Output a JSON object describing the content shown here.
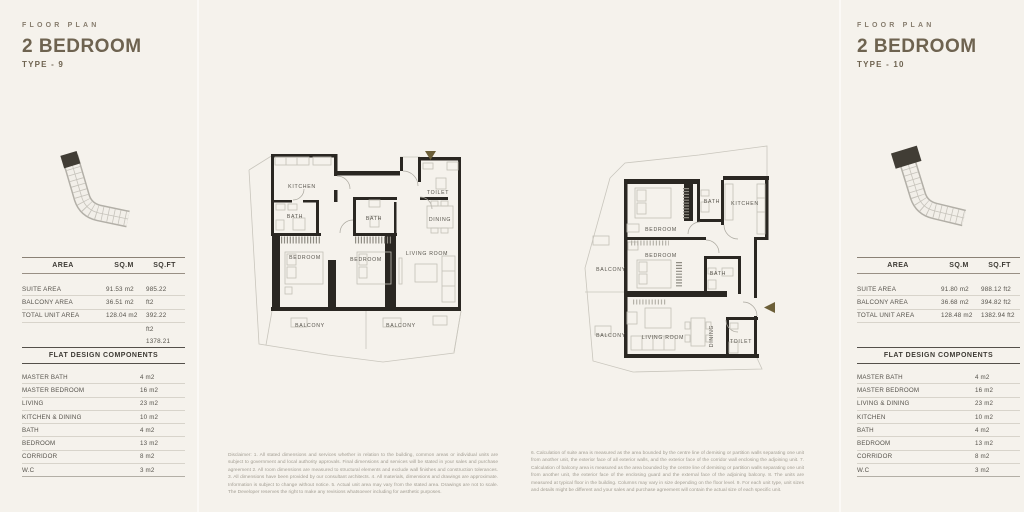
{
  "left": {
    "eyebrow": "FLOOR PLAN",
    "title": "2 BEDROOM",
    "type_label": "TYPE - 9",
    "area": {
      "headers": [
        "AREA",
        "SQ.M",
        "SQ.FT"
      ],
      "rows": [
        {
          "label": "SUITE AREA",
          "sqm": "91.53 m2",
          "sqft": "985.22"
        },
        {
          "label": "BALCONY AREA",
          "sqm": "36.51 m2",
          "sqft": "ft2"
        },
        {
          "label": "TOTAL UNIT AREA",
          "sqm": "128.04 m2",
          "sqft": "392.22"
        },
        {
          "label": "",
          "sqm": "",
          "sqft": "ft2"
        },
        {
          "label": "",
          "sqm": "",
          "sqft": "1378.21"
        }
      ]
    },
    "components_title": "FLAT DESIGN COMPONENTS",
    "components": [
      {
        "label": "MASTER BATH",
        "value": "4 m2"
      },
      {
        "label": "MASTER BEDROOM",
        "value": "16 m2"
      },
      {
        "label": "LIVING",
        "value": "23 m2"
      },
      {
        "label": "KITCHEN & DINING",
        "value": "10 m2"
      },
      {
        "label": "BATH",
        "value": "4 m2"
      },
      {
        "label": "BEDROOM",
        "value": "13 m2"
      },
      {
        "label": "CORRIDOR",
        "value": "8 m2"
      },
      {
        "label": "W.C",
        "value": "3 m2"
      }
    ]
  },
  "right": {
    "eyebrow": "FLOOR PLAN",
    "title": "2 BEDROOM",
    "type_label": "TYPE - 10",
    "area": {
      "headers": [
        "AREA",
        "SQ.M",
        "SQ.FT"
      ],
      "rows": [
        {
          "label": "SUITE AREA",
          "sqm": "91.80 m2",
          "sqft": "988.12 ft2"
        },
        {
          "label": "BALCONY AREA",
          "sqm": "36.68 m2",
          "sqft": "394.82 ft2"
        },
        {
          "label": "TOTAL UNIT AREA",
          "sqm": "128.48 m2",
          "sqft": "1382.94 ft2"
        }
      ]
    },
    "components_title": "FLAT DESIGN COMPONENTS",
    "components": [
      {
        "label": "MASTER BATH",
        "value": "4 m2"
      },
      {
        "label": "MASTER BEDROOM",
        "value": "16 m2"
      },
      {
        "label": "LIVING & DINING",
        "value": "23 m2"
      },
      {
        "label": "KITCHEN",
        "value": "10 m2"
      },
      {
        "label": "BATH",
        "value": "4 m2"
      },
      {
        "label": "BEDROOM",
        "value": "13 m2"
      },
      {
        "label": "CORRIDOR",
        "value": "8 m2"
      },
      {
        "label": "W.C",
        "value": "3 m2"
      }
    ]
  },
  "plan_a": {
    "rooms": {
      "kitchen": "KITCHEN",
      "bath1": "BATH",
      "bedroom1": "BEDROOM",
      "bath2": "BATH",
      "bedroom2": "BEDROOM",
      "living": "LIVING ROOM",
      "toilet": "TOILET",
      "dining": "DINING",
      "balcony1": "BALCONY",
      "balcony2": "BALCONY"
    }
  },
  "plan_b": {
    "rooms": {
      "bedroom1": "BEDROOM",
      "bath1": "BATH",
      "kitchen": "KITCHEN",
      "bedroom2": "BEDROOM",
      "bath2": "BATH",
      "living": "LIVING ROOM",
      "dining": "DINING",
      "toilet": "TOILET",
      "balcony1": "BALCONY",
      "balcony2": "BALCONY"
    }
  },
  "disclaimers": {
    "left": "Disclaimer: 1. All stated dimensions and services whether in relation to the building, common areas or individual units are subject to government and local authority approvals. Final dimensions and services will be stated in your sales and purchase agreement 2. All room dimensions are measured to structural elements and exclude wall finishes and construction tolerances. 3. All dimensions have been provided by our consultant architects. 4. All materials, dimensions and drawings are approximate. Information is subject to change without notice. 5. Actual unit area may vary from the stated area. Drawings are not to scale. The Developer reserves the right to make any revisions whatsoever including for aesthetic purposes.",
    "right": "6. Calculation of suite area is measured as the area bounded by the centre line of demising or partition walls separating one unit from another unit, the exterior face of all exterior walls, and the exterior face of the corridor wall enclosing the adjoining unit. 7. Calculation of balcony area is measured as the area bounded by the centre line of demising or partition walls separating one unit from another unit, the exterior face of the enclosing guard and the external face of the adjoining balcony. 8. The units are measured at typical floor in the building. Columns may vary in size depending on the floor level. 9. For each unit type, unit sizes and details might be different and your sales and purchase agreement will contain the actual size of each specific unit."
  },
  "colors": {
    "background": "#f5f2ec",
    "accent_brown": "#6e6350",
    "wall": "#2a2722",
    "entry_arrow": "#6c5f38",
    "highlight_unit": "#413d35"
  }
}
